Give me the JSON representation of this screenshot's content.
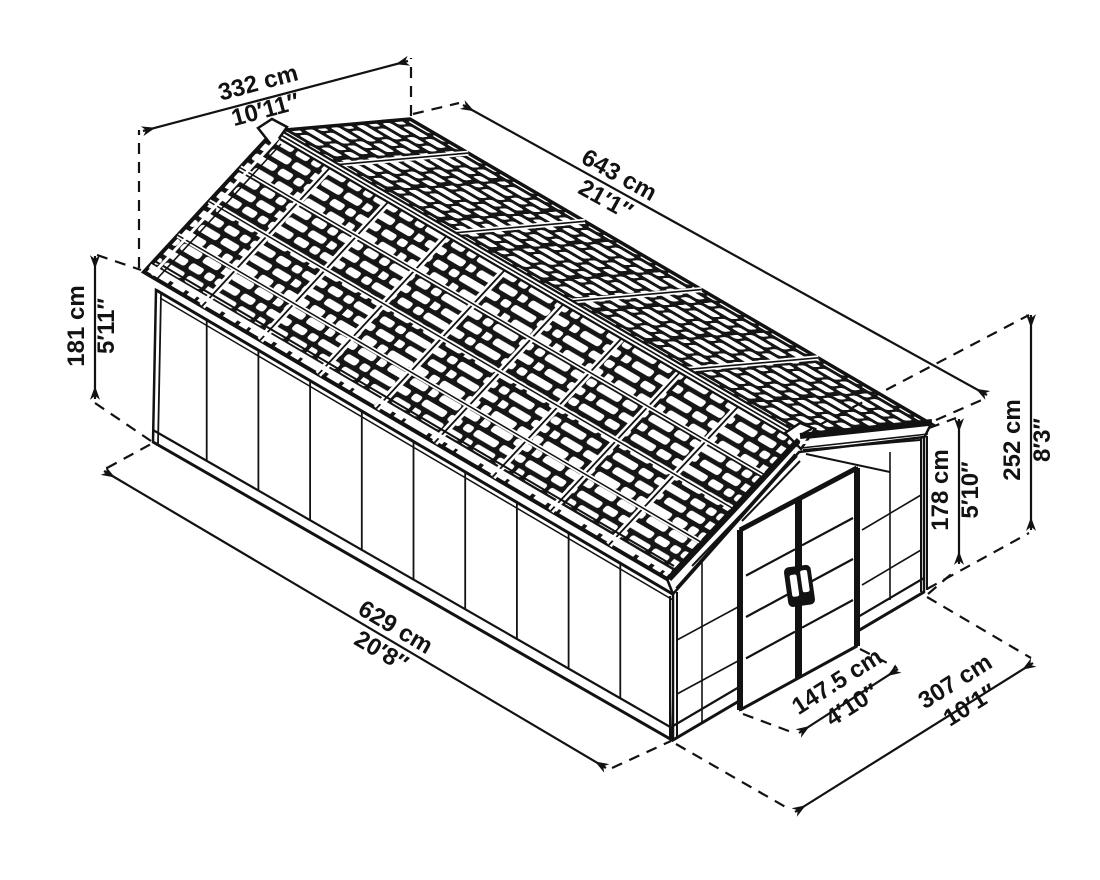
{
  "diagram": {
    "type": "isometric-shed-dimension-drawing",
    "background_color": "#ffffff",
    "line_color": "#121212",
    "dimensions": [
      {
        "id": "gable-width",
        "metric": "332 cm",
        "imperial": "10′11″"
      },
      {
        "id": "roof-length",
        "metric": "643 cm",
        "imperial": "21′1″"
      },
      {
        "id": "eave-height",
        "metric": "181 cm",
        "imperial": "5′11″"
      },
      {
        "id": "ridge-height",
        "metric": "252 cm",
        "imperial": "8′3″"
      },
      {
        "id": "door-height",
        "metric": "178 cm",
        "imperial": "5′10″"
      },
      {
        "id": "side-length",
        "metric": "629 cm",
        "imperial": "20′8″"
      },
      {
        "id": "door-width",
        "metric": "147.5 cm",
        "imperial": "4′10″"
      },
      {
        "id": "front-width",
        "metric": "307 cm",
        "imperial": "10′1″"
      }
    ]
  }
}
